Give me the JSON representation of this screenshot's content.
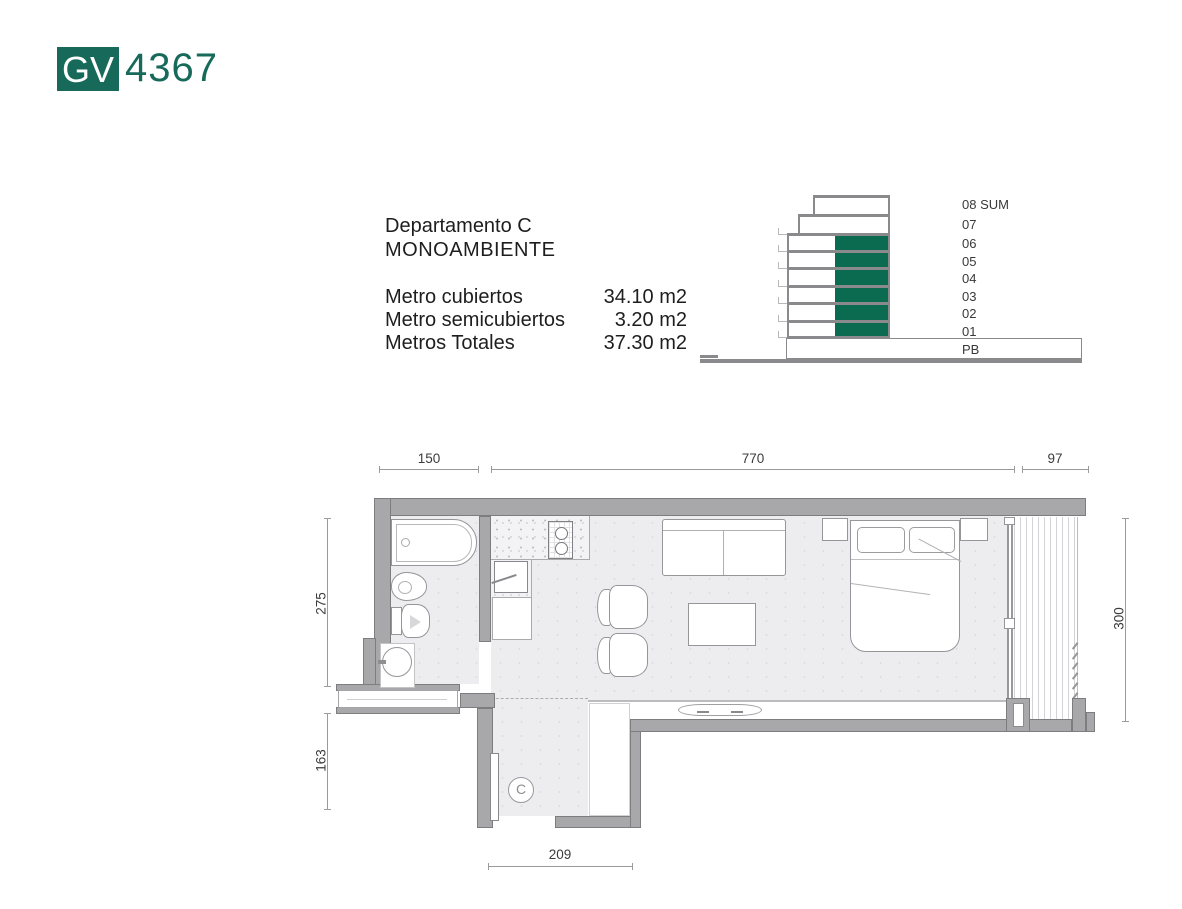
{
  "colors": {
    "green": "#17695a",
    "green_dark": "#0b6b50",
    "wall": "#a8a8aa",
    "wall_border": "#7d7d7f",
    "floor": "#ededef"
  },
  "logo": {
    "badge": "GV",
    "code": "4367"
  },
  "info": {
    "title_line1": "Departamento C",
    "title_line2": "MONOAMBIENTE",
    "rows": [
      {
        "label": "Metro cubiertos",
        "value": "34.10 m2"
      },
      {
        "label": "Metro semicubiertos",
        "value": "3.20 m2"
      },
      {
        "label": "Metros Totales",
        "value": "37.30 m2"
      }
    ]
  },
  "elevation": {
    "floors": [
      "08 SUM",
      "07",
      "06",
      "05",
      "04",
      "03",
      "02",
      "01",
      "PB"
    ],
    "highlighted_floors": [
      "06",
      "05",
      "04",
      "03",
      "02",
      "01"
    ]
  },
  "plan": {
    "unit_label": "C",
    "dims": {
      "top_left": "150",
      "top_mid": "770",
      "top_right": "97",
      "left_upper": "275",
      "left_lower": "163",
      "right": "300",
      "bottom": "209"
    }
  }
}
